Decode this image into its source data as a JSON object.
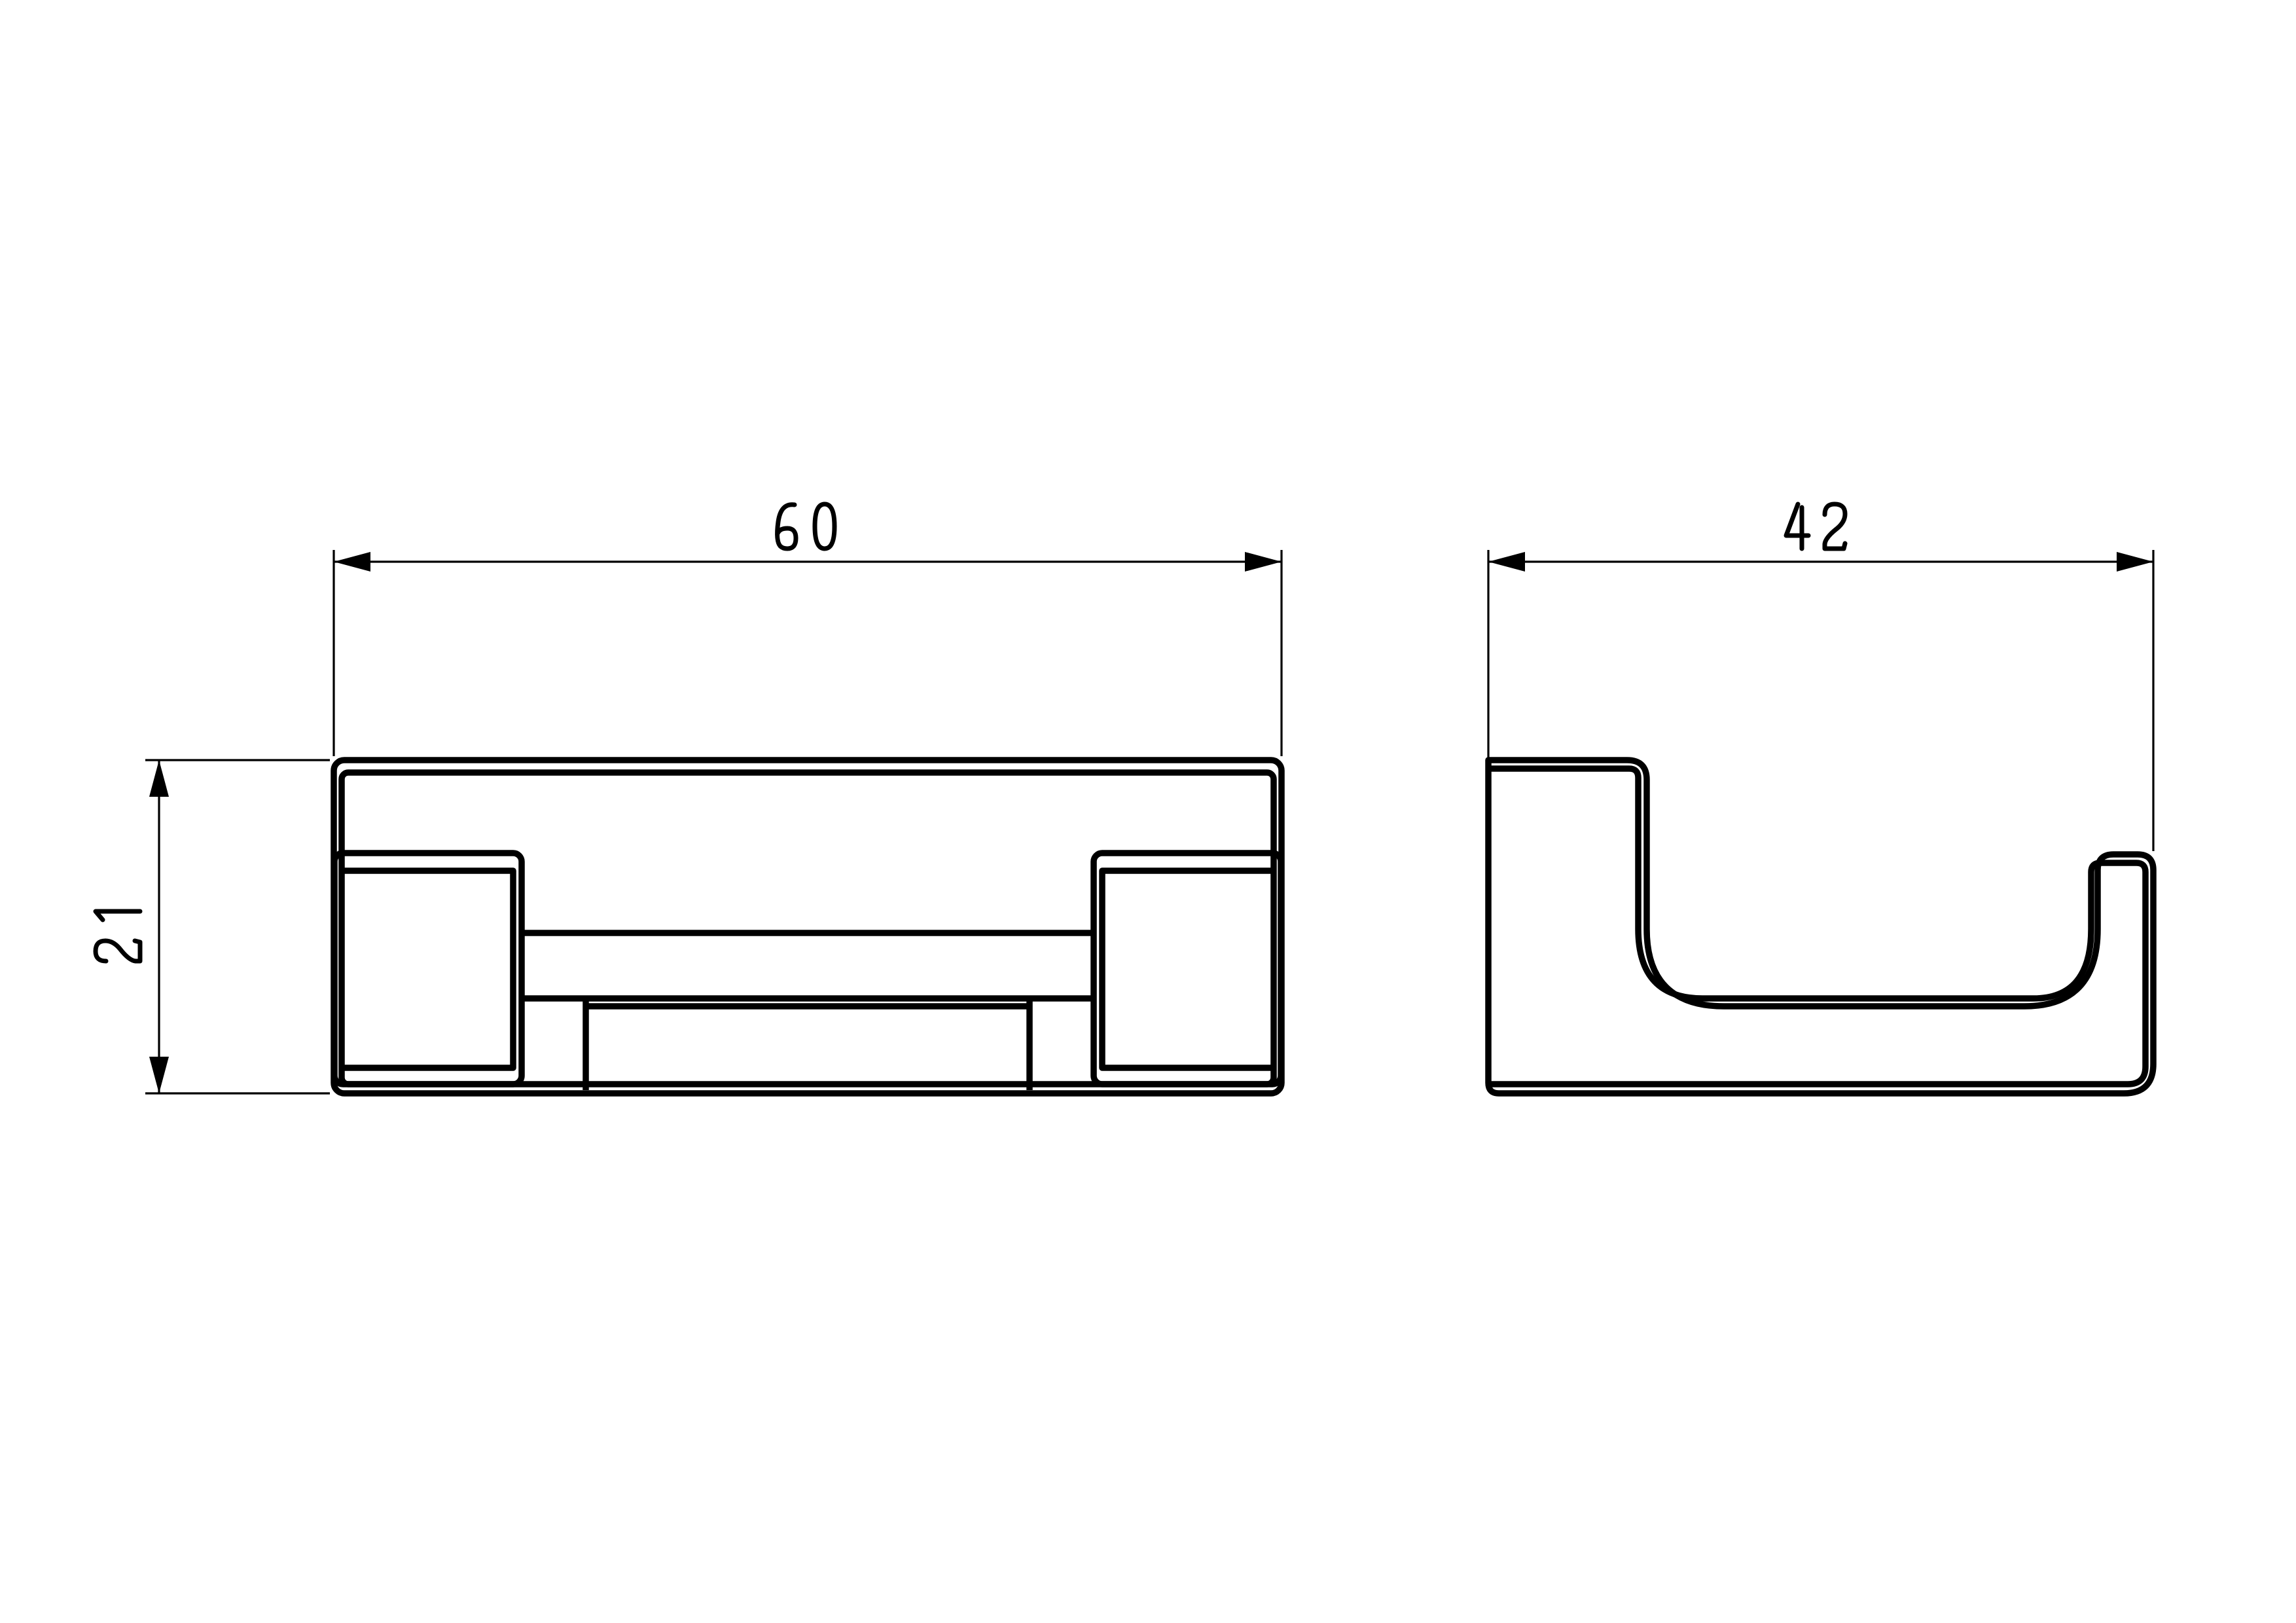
{
  "page": {
    "background": "#ffffff",
    "line_color": "#000000"
  },
  "drawing": {
    "kind": "2-view orthographic technical drawing of a wall hook bracket",
    "views": {
      "front": {
        "id": "front-view"
      },
      "side": {
        "id": "side-view"
      }
    },
    "dimensions": {
      "width": {
        "value": "60"
      },
      "depth": {
        "value": "42"
      },
      "height": {
        "value": "21"
      }
    }
  }
}
